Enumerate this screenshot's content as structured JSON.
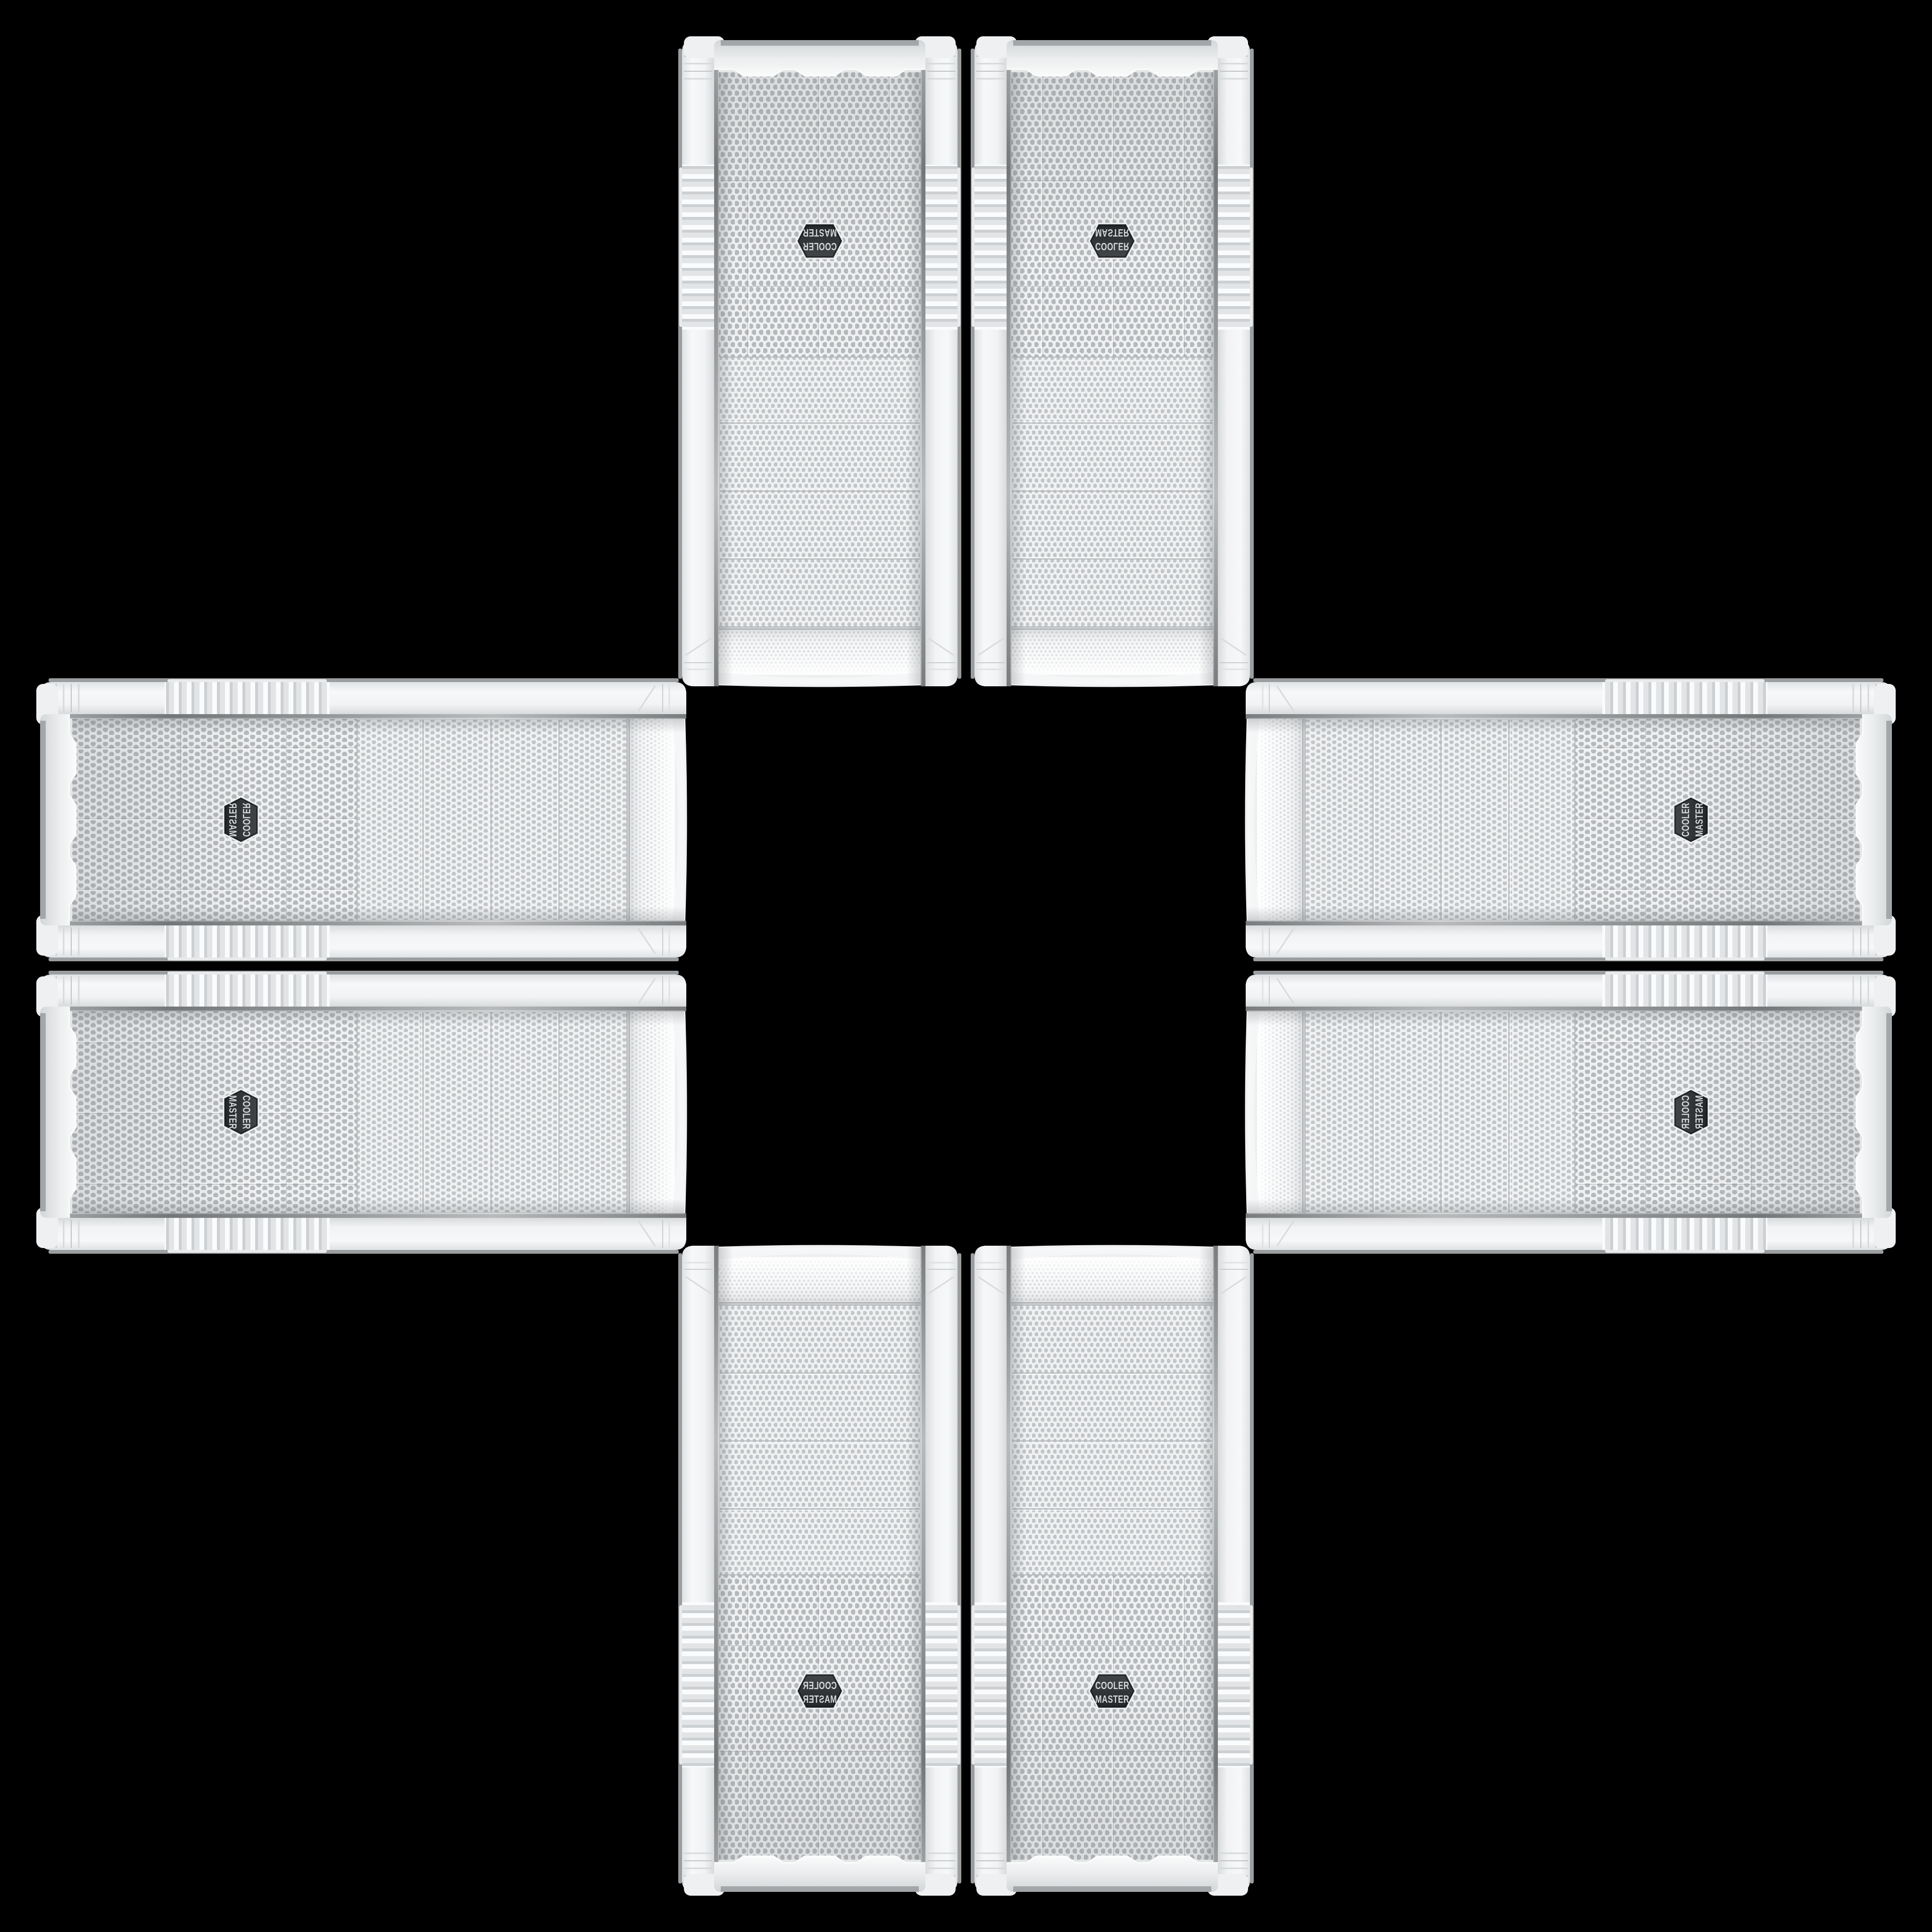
{
  "scene": {
    "description": "Eight identical white Cooler Master mid-tower PC cases (front panel views) arranged in a four-fold mirrored cross / plus pattern on a solid black background",
    "background_color": "#000000",
    "tile_count": 8
  },
  "case_front": {
    "brand": "Cooler Master",
    "badge": {
      "line1": "COOLER",
      "line2": "MASTER"
    },
    "features": [
      "curved fine-mesh top section",
      "four mesh drive-bay covers",
      "large perforated fan mesh with center badge",
      "ribbed grip sections on both side rails",
      "white bottom cap with three trapezoid bumps and corner feet"
    ],
    "colors": {
      "shell_white": "#f3f4f5",
      "shell_shadow": "#d8dbdd",
      "side_edge_gray": "#9b9ea0",
      "mesh_fine_bg": "#f7f8f9",
      "mesh_fine_dot": "#d5d8da",
      "mesh_mid_bg": "#eff1f2",
      "mesh_mid_dot": "#c2c5c8",
      "mesh_big_bg": "#eef0f1",
      "mesh_big_dot": "#b6b9bc",
      "chrome_edge": "#a9acae",
      "badge_background": "#2c2f31",
      "badge_text": "#d4d7d9",
      "background": "#000000"
    }
  },
  "icons": [
    {
      "name": "cooler-master-badge",
      "description": "hexagonal dark badge with two lines of brand text"
    }
  ],
  "tiles": [
    {
      "id": "case-top-left",
      "position": "top row, left",
      "orientation": "rotated 180°"
    },
    {
      "id": "case-top-right",
      "position": "top row, right",
      "orientation": "flipped vertically"
    },
    {
      "id": "case-left-top",
      "position": "left column, top",
      "orientation": "rotated 90° CW, flipped vertically"
    },
    {
      "id": "case-left-bottom",
      "position": "left column, bottom",
      "orientation": "rotated 90° CW"
    },
    {
      "id": "case-right-top",
      "position": "right column, top",
      "orientation": "rotated 90° CCW"
    },
    {
      "id": "case-right-bottom",
      "position": "right column, bottom",
      "orientation": "rotated 90° CW, mirrored"
    },
    {
      "id": "case-bottom-left",
      "position": "bottom row, left",
      "orientation": "mirrored horizontally"
    },
    {
      "id": "case-bottom-right",
      "position": "bottom row, right",
      "orientation": "upright"
    }
  ]
}
